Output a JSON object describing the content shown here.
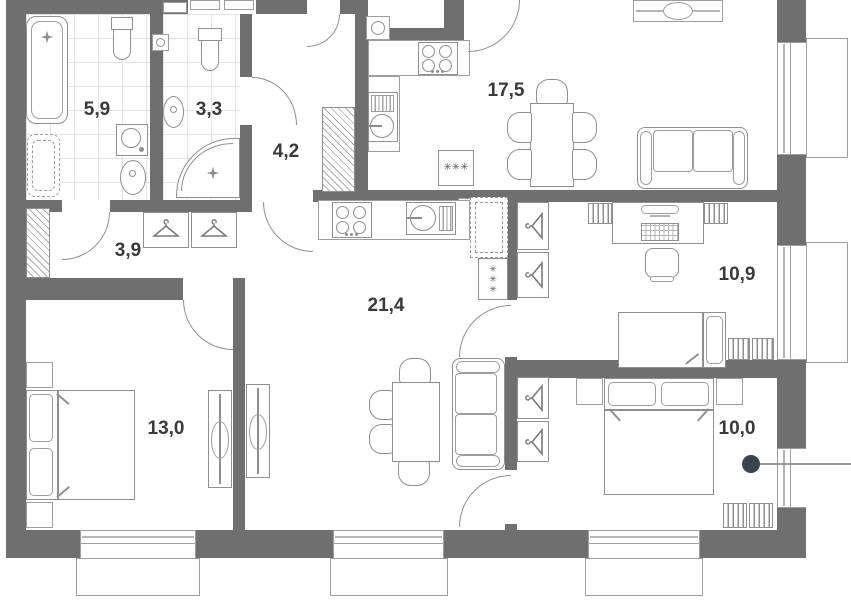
{
  "floor_plan": {
    "rooms": [
      {
        "id": "bathroom-large",
        "area_label": "5,9"
      },
      {
        "id": "bathroom-small",
        "area_label": "3,3"
      },
      {
        "id": "entry-hall",
        "area_label": "4,2"
      },
      {
        "id": "corridor",
        "area_label": "3,9"
      },
      {
        "id": "living-kitchen",
        "area_label": "17,5"
      },
      {
        "id": "kitchen-living",
        "area_label": "21,4"
      },
      {
        "id": "bedroom-study",
        "area_label": "10,9"
      },
      {
        "id": "bedroom-master",
        "area_label": "13,0"
      },
      {
        "id": "bedroom-second",
        "area_label": "10,0"
      }
    ],
    "symbols": {
      "appliance_marks": "✳✳✳"
    },
    "icons": {
      "hanger-icon": "clothes hanger (triangle with hook)",
      "sparkle-icon": "four point star drain mark",
      "vent-icon": "square with circle"
    },
    "colors": {
      "wall": "#6F6F6F",
      "furniture_line": "#8F8F8F",
      "tile_line": "#E3E3E3",
      "marker": "#3A4450",
      "background": "#FFFFFF"
    }
  }
}
